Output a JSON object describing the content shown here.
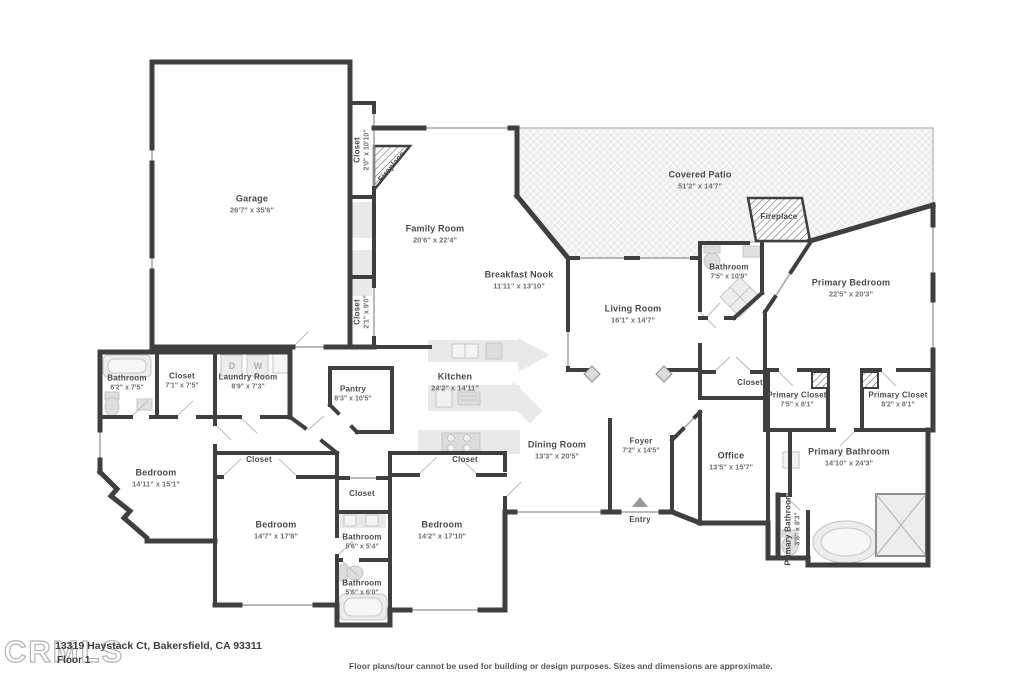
{
  "watermark": "CRMLS",
  "footer": {
    "address": "13319 Haystack Ct, Bakersfield, CA 93311",
    "floor_label": "Floor 1",
    "disclaimer": "Floor plans/tour cannot be used for building or design purposes. Sizes and dimensions are approximate."
  },
  "colors": {
    "wall": "#3f3f3f",
    "fixture": "#e9e9e9",
    "patio_check": "#ececec",
    "label_text": "#4a4a4a",
    "dims_text": "#6f6f6f"
  },
  "rooms": [
    {
      "name": "Garage",
      "dims": "26'7\" x 35'6\"",
      "x": 252,
      "y": 204
    },
    {
      "name": "Closet",
      "dims": "2'0\" x 10'10\"",
      "x": 362,
      "y": 150,
      "rot": -90,
      "cls": "sm"
    },
    {
      "name": "Fireplace",
      "dims": "",
      "x": 392,
      "y": 167,
      "rot": -50,
      "cls": "sm"
    },
    {
      "name": "Family Room",
      "dims": "20'6\" x 22'4\"",
      "x": 435,
      "y": 234
    },
    {
      "name": "Covered Patio",
      "dims": "51'2\" x 14'7\"",
      "x": 700,
      "y": 180
    },
    {
      "name": "Fireplace",
      "dims": "",
      "x": 779,
      "y": 217,
      "cls": "sm"
    },
    {
      "name": "Breakfast Nook",
      "dims": "11'11\" x 13'10\"",
      "x": 519,
      "y": 280
    },
    {
      "name": "Living Room",
      "dims": "16'1\" x 14'7\"",
      "x": 633,
      "y": 314
    },
    {
      "name": "Bathroom",
      "dims": "7'5\" x 10'9\"",
      "x": 729,
      "y": 272,
      "cls": "sm"
    },
    {
      "name": "Primary Bedroom",
      "dims": "22'5\" x 20'3\"",
      "x": 851,
      "y": 288
    },
    {
      "name": "Closet",
      "dims": "2'1\" x 9'0\"",
      "x": 362,
      "y": 312,
      "rot": -90,
      "cls": "sm"
    },
    {
      "name": "Bathroom",
      "dims": "6'2\" x 7'5\"",
      "x": 127,
      "y": 383,
      "cls": "sm"
    },
    {
      "name": "Closet",
      "dims": "7'1\" x 7'5\"",
      "x": 182,
      "y": 381,
      "cls": "sm"
    },
    {
      "name": "Laundry Room",
      "dims": "8'9\" x 7'3\"",
      "x": 248,
      "y": 382,
      "cls": "sm"
    },
    {
      "name": "Pantry",
      "dims": "8'3\" x 10'5\"",
      "x": 353,
      "y": 394,
      "cls": "sm"
    },
    {
      "name": "Kitchen",
      "dims": "24'2\" x 14'11\"",
      "x": 455,
      "y": 382
    },
    {
      "name": "Bedroom",
      "dims": "14'11\" x 15'1\"",
      "x": 156,
      "y": 478
    },
    {
      "name": "Closet",
      "dims": "",
      "x": 259,
      "y": 460,
      "cls": "sm"
    },
    {
      "name": "Bedroom",
      "dims": "14'7\" x 17'8\"",
      "x": 276,
      "y": 530
    },
    {
      "name": "Closet",
      "dims": "",
      "x": 362,
      "y": 494,
      "cls": "sm"
    },
    {
      "name": "Bathroom",
      "dims": "5'6\" x 5'4\"",
      "x": 362,
      "y": 542,
      "cls": "sm"
    },
    {
      "name": "Bathroom",
      "dims": "5'6\" x 6'0\"",
      "x": 362,
      "y": 588,
      "cls": "sm"
    },
    {
      "name": "Closet",
      "dims": "",
      "x": 465,
      "y": 460,
      "cls": "sm"
    },
    {
      "name": "Bedroom",
      "dims": "14'2\" x 17'10\"",
      "x": 442,
      "y": 530
    },
    {
      "name": "Dining Room",
      "dims": "13'3\" x 20'5\"",
      "x": 557,
      "y": 450
    },
    {
      "name": "Foyer",
      "dims": "7'2\" x 14'5\"",
      "x": 641,
      "y": 446,
      "cls": "sm"
    },
    {
      "name": "Entry",
      "dims": "",
      "x": 640,
      "y": 520,
      "cls": "sm"
    },
    {
      "name": "Office",
      "dims": "13'5\" x 15'7\"",
      "x": 731,
      "y": 461
    },
    {
      "name": "Closet",
      "dims": "",
      "x": 750,
      "y": 383,
      "cls": "sm"
    },
    {
      "name": "Primary Closet",
      "dims": "7'5\" x 8'1\"",
      "x": 797,
      "y": 400,
      "cls": "sm"
    },
    {
      "name": "Primary Closet",
      "dims": "8'2\" x 8'1\"",
      "x": 898,
      "y": 400,
      "cls": "sm"
    },
    {
      "name": "Primary Bathroom",
      "dims": "14'10\" x 24'3\"",
      "x": 849,
      "y": 457
    },
    {
      "name": "Primary Bathroom",
      "dims": "3'8\" x 8'3\"",
      "x": 793,
      "y": 529,
      "rot": -90,
      "cls": "sm"
    }
  ],
  "fixture_labels": [
    {
      "text": "D",
      "x": 232,
      "y": 366
    },
    {
      "text": "W",
      "x": 258,
      "y": 366
    }
  ]
}
